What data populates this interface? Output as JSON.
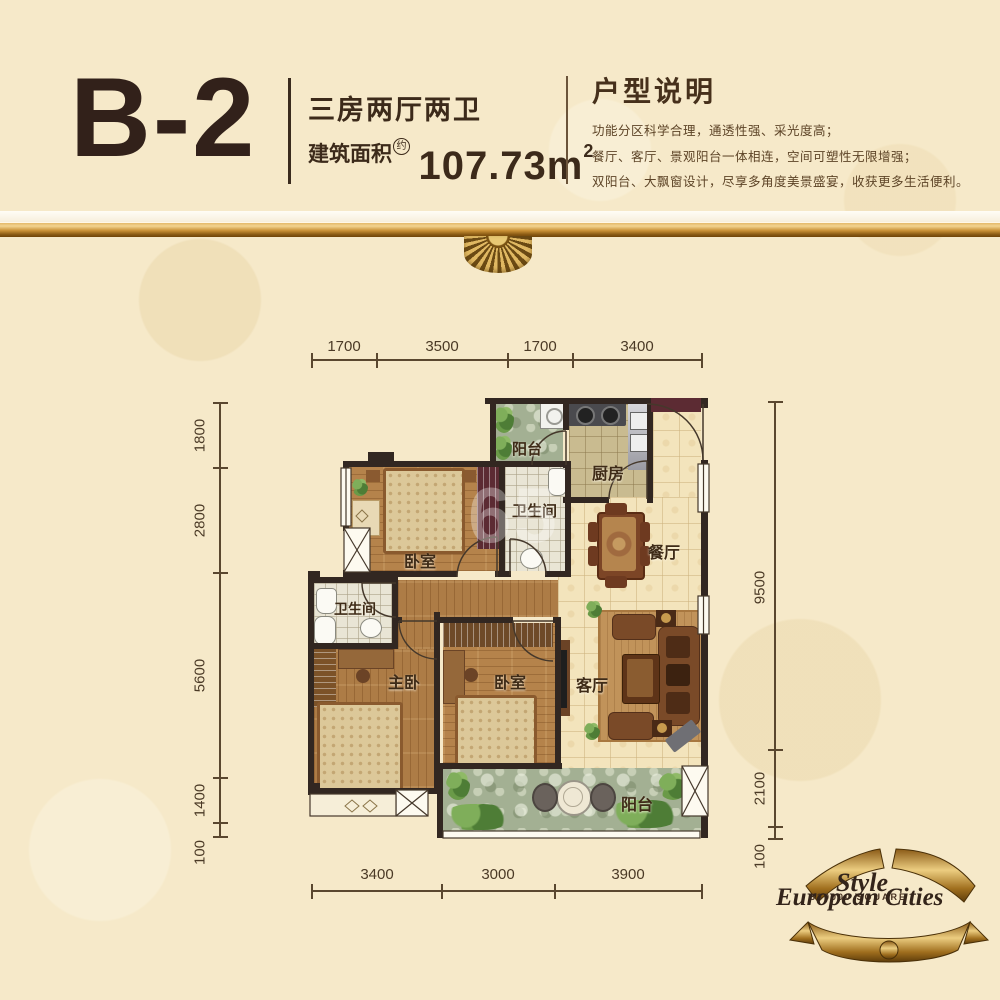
{
  "header": {
    "unit": "B-2",
    "layout": "三房两厅两卫",
    "area_label": "建筑面积",
    "area_approx": "约",
    "area_value": "107.73",
    "area_unit": "m",
    "area_sup": "2"
  },
  "description": {
    "title": "户型说明",
    "lines": [
      "功能分区科学合理，通透性强、采光度高；",
      "餐厅、客厅、景观阳台一体相连，空间可塑性无限增强；",
      "双阳台、大飘窗设计，尽享多角度美景盛宴，收获更多生活便利。"
    ]
  },
  "dimensions": {
    "top": [
      "1700",
      "3500",
      "1700",
      "3400"
    ],
    "bottom": [
      "3400",
      "3000",
      "3900"
    ],
    "left": [
      "1800",
      "2800",
      "5600",
      "1400",
      "100"
    ],
    "right": [
      "9500",
      "2100",
      "100"
    ]
  },
  "rooms": {
    "balcony_top": "阳台",
    "kitchen": "厨房",
    "bath_top": "卫生间",
    "bedroom_top": "卧室",
    "dining": "餐厅",
    "bath_left": "卫生间",
    "master": "主卧",
    "bedroom_mid": "卧室",
    "living": "客厅",
    "balcony_bottom": "阳台"
  },
  "logo": {
    "style": "Style",
    "square": "330000  SQUARE",
    "name": "European Cities"
  },
  "watermark": "65",
  "colors": {
    "background": "#f6e9c9",
    "gold": "#c8913c",
    "wall": "#322721",
    "accent_maroon": "#5c2b33",
    "text_dark": "#32211a"
  }
}
